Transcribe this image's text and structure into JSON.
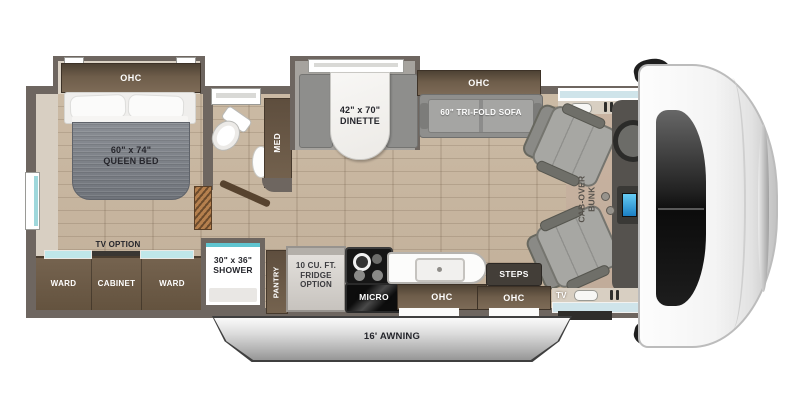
{
  "title": "Class C motorhome floor plan",
  "colors": {
    "wall_dark": "#6e6660",
    "wall_light": "#d8cfc2",
    "floor_wood": "#c8b7a1",
    "cab_floor": "#c6b19f",
    "cabinet_brown": "#6b5a49",
    "slide_gray": "#a6a39e",
    "sofa_gray": "#9b9b99",
    "bed_gray": "#7b8086",
    "accent_teal": "#5fc4cf",
    "window_blue": "#cfe4ea",
    "appliance_black": "#1c1c1c",
    "awning_silver": "#b9b9b9"
  },
  "labels": {
    "bedroom_ohc": "OHC",
    "bed_size": "60\" x 74\"",
    "bed_name": "QUEEN BED",
    "med": "MED",
    "dinette_size": "42\" x 70\"",
    "dinette_name": "DINETTE",
    "living_ohc": "OHC",
    "sofa": "60\" TRI-FOLD SOFA",
    "bunk_line1": "CAB-OVER",
    "bunk_line2": "BUNK",
    "tv_option": "TV OPTION",
    "ward_left": "WARD",
    "cabinet": "CABINET",
    "ward_right": "WARD",
    "shower_size": "30\" x 36\"",
    "shower_name": "SHOWER",
    "pantry": "PANTRY",
    "fridge_line1": "10 CU. FT.",
    "fridge_line2": "FRIDGE",
    "fridge_line3": "OPTION",
    "micro": "MICRO",
    "kitchen_ohc": "OHC",
    "steps": "STEPS",
    "entry_ohc": "OHC",
    "cab_tv": "TV",
    "awning": "16' AWNING"
  }
}
